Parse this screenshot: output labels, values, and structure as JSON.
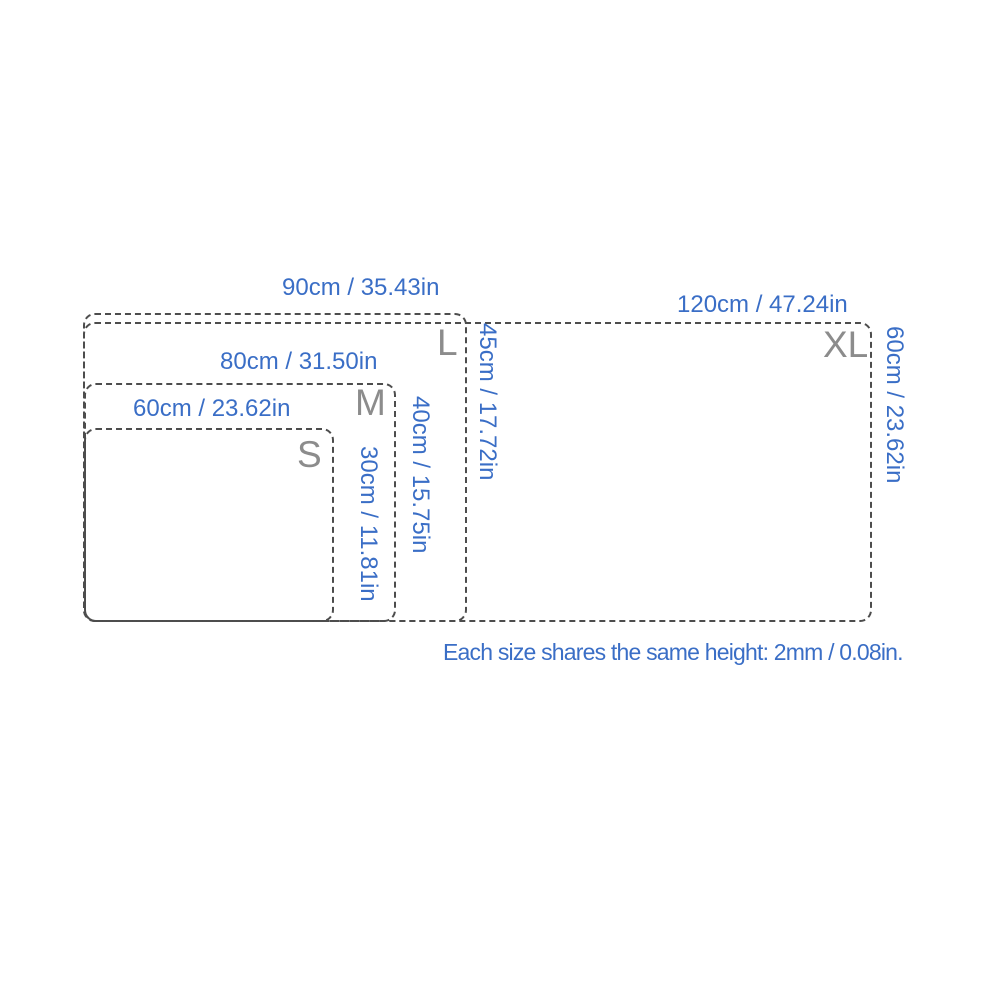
{
  "diagram": {
    "type": "product-size-comparison",
    "note": "Each size shares the same height: 2mm / 0.08in.",
    "colors": {
      "dimension_text": "#3a6ec6",
      "size_letter": "#8c8c8c",
      "outline": "#4d4d4d",
      "background": "#ffffff"
    },
    "sizes": [
      {
        "label": "S",
        "width_label": "60cm / 23.62in",
        "height_label": "30cm / 11.81in"
      },
      {
        "label": "M",
        "width_label": "80cm / 31.50in",
        "height_label": "40cm / 15.75in"
      },
      {
        "label": "L",
        "width_label": "90cm / 35.43in",
        "height_label": "45cm / 17.72in"
      },
      {
        "label": "XL",
        "width_label": "120cm / 47.24in",
        "height_label": "60cm / 23.62in"
      }
    ]
  }
}
